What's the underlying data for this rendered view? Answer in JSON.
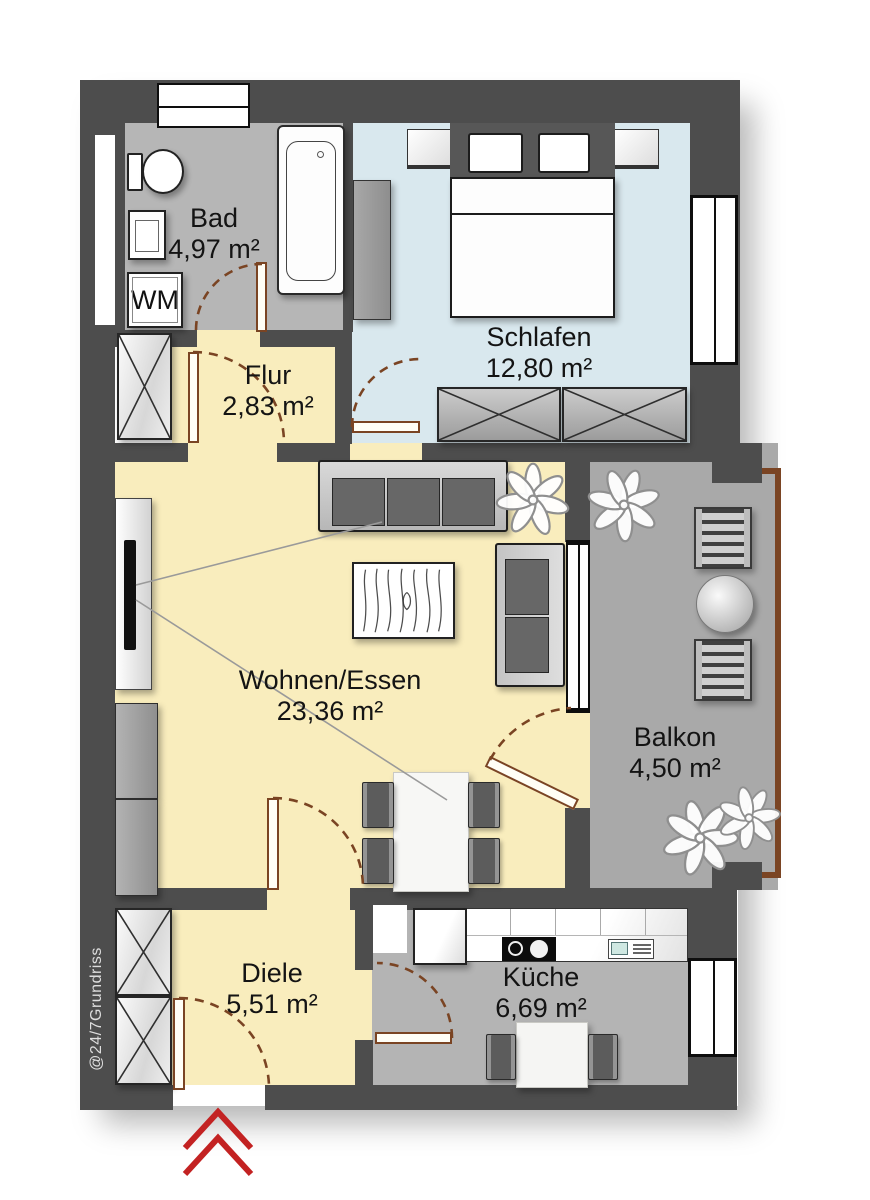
{
  "watermark": "@24/7Grundriss",
  "rooms": {
    "bad": {
      "name": "Bad",
      "area": "4,97 m²"
    },
    "flur": {
      "name": "Flur",
      "area": "2,83 m²"
    },
    "schlafen": {
      "name": "Schlafen",
      "area": "12,80 m²"
    },
    "wohnen": {
      "name": "Wohnen/Essen",
      "area": "23,36 m²"
    },
    "balkon": {
      "name": "Balkon",
      "area": "4,50 m²"
    },
    "diele": {
      "name": "Diele",
      "area": "5,51 m²"
    },
    "kueche": {
      "name": "Küche",
      "area": "6,69 m²"
    }
  },
  "appliances": {
    "washing_machine": "WM"
  },
  "colors": {
    "wall": "#4d4d4d",
    "floor_wohnen": "#f9edbd",
    "floor_schlafen": "#d9e8ee",
    "floor_bad": "#b6b6b6",
    "floor_kueche": "#b4b4b4",
    "floor_balkon": "#a9a9a9",
    "door": "#7a4423",
    "arrow": "#c32222"
  }
}
